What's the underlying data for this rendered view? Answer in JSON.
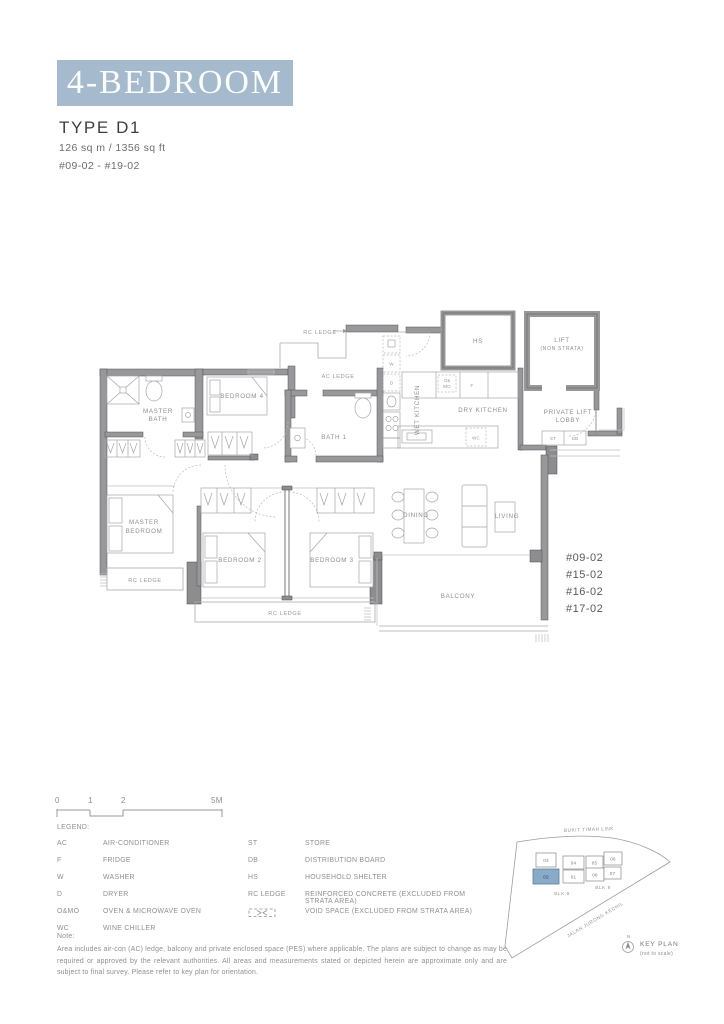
{
  "header": {
    "banner": "4-BEDROOM",
    "type": "TYPE D1",
    "area": "126 sq m / 1356 sq ft",
    "units_range": "#09-02 - #19-02",
    "banner_color": "#a5bacd"
  },
  "plan": {
    "rooms": {
      "master_bath": [
        "MASTER",
        "BATH"
      ],
      "bedroom4": "BEDROOM 4",
      "bath1": "BATH 1",
      "wet_kitchen": "WET KITCHEN",
      "dry_kitchen": "DRY KITCHEN",
      "hs": "HS",
      "lift": [
        "LIFT",
        "(NON STRATA)"
      ],
      "lobby": [
        "PRIVATE LIFT",
        "LOBBY"
      ],
      "master_bedroom": [
        "MASTER",
        "BEDROOM"
      ],
      "bedroom2": "BEDROOM 2",
      "bedroom3": "BEDROOM 3",
      "dining": "DINING",
      "living": "LIVING",
      "balcony": "BALCONY"
    },
    "ledges": {
      "rc_top": "RC LEDGE",
      "ac": "AC LEDGE",
      "rc_left": "RC LEDGE",
      "rc_bottom": "RC LEDGE"
    },
    "fixtures": {
      "w": "W",
      "d": "D",
      "omo1": "O&",
      "omo2": "MO",
      "f": "F",
      "wc": "WC",
      "st": "ST",
      "db": "DB"
    },
    "stack_units": [
      "#09-02",
      "#15-02",
      "#16-02",
      "#17-02"
    ]
  },
  "scale": {
    "t0": "0",
    "t1": "1",
    "t2": "2",
    "t5": "5M"
  },
  "legend": {
    "title": "LEGEND:",
    "left": [
      {
        "term": "AC",
        "desc": "AIR-CONDITIONER"
      },
      {
        "term": "F",
        "desc": "FRIDGE"
      },
      {
        "term": "W",
        "desc": "WASHER"
      },
      {
        "term": "D",
        "desc": "DRYER"
      },
      {
        "term": "O&MO",
        "desc": "OVEN & MICROWAVE OVEN"
      },
      {
        "term": "WC",
        "desc": "WINE CHILLER"
      }
    ],
    "right": [
      {
        "term": "ST",
        "desc": "STORE"
      },
      {
        "term": "DB",
        "desc": "DISTRIBUTION BOARD"
      },
      {
        "term": "HS",
        "desc": "HOUSEHOLD SHELTER"
      },
      {
        "term": "RC LEDGE",
        "desc": "REINFORCED CONCRETE (EXCLUDED FROM STRATA AREA)"
      },
      {
        "term": "",
        "desc": "VOID SPACE (EXCLUDED FROM STRATA AREA)"
      }
    ]
  },
  "note": {
    "title": "Note:",
    "body": "Area includes air-con (AC) ledge, balcony and private enclosed space (PES) where applicable. The plans are subject to change as may be required or approved by the relevant authorities. All areas and measurements stated or depicted herein are approximate only and are subject to final survey. Please refer to key plan for orientation."
  },
  "keyplan": {
    "road_top": "BUKIT TIMAH LINK",
    "road_diag": "JALAN JURONG KECHIL",
    "blk6": "BLK 6",
    "blk8": "BLK 8",
    "north": "N",
    "caption": "KEY PLAN",
    "caption_sub": "(not to scale)",
    "units": {
      "u03": "03",
      "u04": "04",
      "u05": "05",
      "u06": "06",
      "u02": "02",
      "u01": "01",
      "u08": "08",
      "u07": "07"
    },
    "highlighted_unit": "02",
    "highlight_color": "#87abc9"
  }
}
